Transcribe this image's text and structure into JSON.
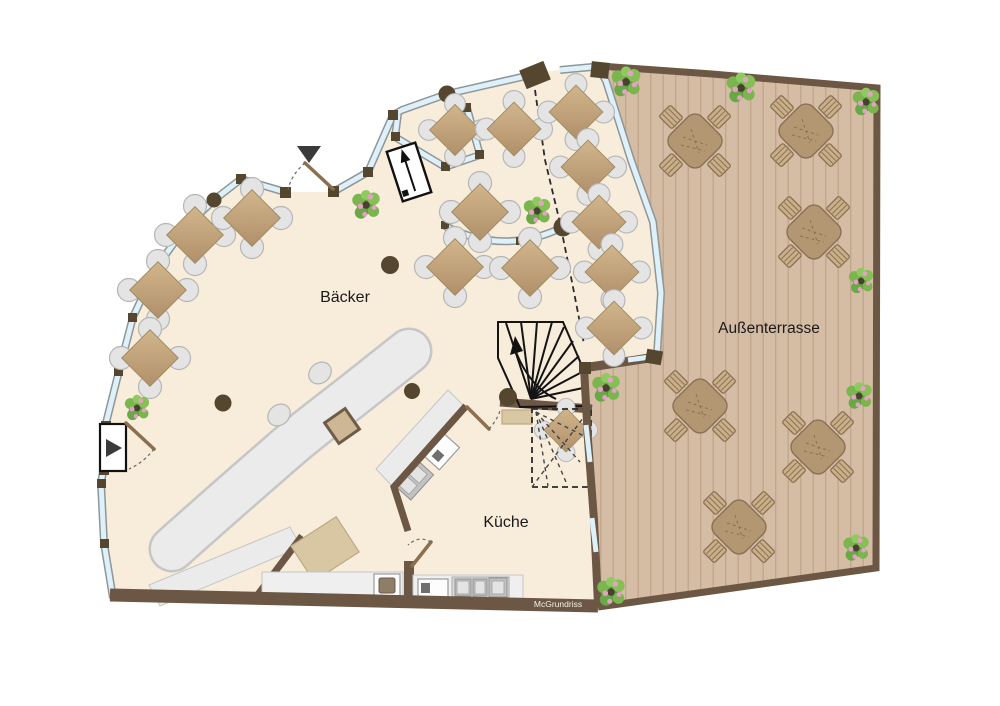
{
  "floorplan": {
    "rooms": [
      {
        "id": "baecker",
        "label": "Bäcker"
      },
      {
        "id": "kueche",
        "label": "Küche"
      },
      {
        "id": "aussenterrasse",
        "label": "Außenterrasse"
      }
    ],
    "watermark": "McGrundriss",
    "furniture": {
      "indoor_dining_tables": 14,
      "understair_table": 1,
      "terrace_tables": 6,
      "counter_stools": 2,
      "plants": 11,
      "entrances": 2
    },
    "features": [
      "curved-sales-counter",
      "winder-staircase-with-up-arrow",
      "dashed-stair-outline-below",
      "kitchen-appliance-counters",
      "glazed-facade-with-posts",
      "wood-deck-terrace",
      "entrance-arrows",
      "ramp-arrow-symbol",
      "roof-edge-dashed-line"
    ],
    "colors": {
      "floor": "#f8ecdb",
      "deck": "#d5bca4",
      "deck_line": "#c0a58b",
      "wall": "#6b5743",
      "window": "#def1fa",
      "table": "#c3a378",
      "chair": "#e4e4e4",
      "counter": "#ebebeb",
      "terrace_table": "#b29772",
      "plant_green": "#72a844",
      "plant_pink": "#e3a1c6"
    }
  }
}
